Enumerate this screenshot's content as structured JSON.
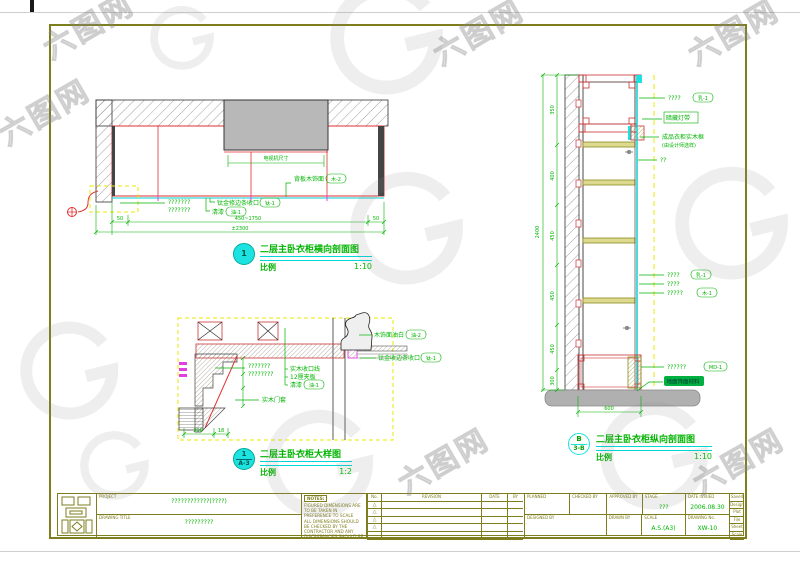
{
  "watermark": {
    "text": "六图网"
  },
  "d1": {
    "bubble": "1",
    "title": "二层主卧衣柜横向剖面图",
    "scale_label": "比例",
    "scale": "1:10",
    "niche_dim": "电视机尺寸",
    "q1": "???????",
    "q2": "???????",
    "lbl_ti": "钛金修边条收口",
    "tag_ti": "钛-1",
    "lbl_qi": "清漆",
    "tag_qi": "油-1",
    "lbl_back": "背板木饰面",
    "tag_back": "木-2",
    "dim_50l": "50",
    "dim_mid": "450~1750",
    "dim_50r": "50",
    "dim_total": "±2300"
  },
  "d2": {
    "bubble_top": "1",
    "bubble_bottom": "A-3",
    "title": "二层主卧衣柜大样图",
    "scale_label": "比例",
    "scale": "1:2",
    "q1": "???????",
    "q2": "????????",
    "lbl_door": "实木门套",
    "lbl_trim": "实木收口线",
    "lbl_ply": "12厘夹板",
    "lbl_qi": "清漆",
    "tag_qi": "油-1",
    "lbl_white": "木饰面油白",
    "tag_white": "油-2",
    "lbl_ti": "钛金收边条收口",
    "tag_ti": "钛-1",
    "dim_a": "206",
    "dim_b": "18"
  },
  "d3": {
    "bubble_top": "B",
    "bubble_bottom": "3-B",
    "title": "二层主卧衣柜纵向剖面图",
    "scale_label": "比例",
    "scale": "1:10",
    "r1": "????",
    "r1tag": "乳-1",
    "r2": "暗藏灯带",
    "r3a": "成品衣柜实木框",
    "r3b": "(由设计师选样)",
    "r4": "??",
    "r5": "????",
    "r5tag": "乳-1",
    "r6": "????",
    "r7": "?????",
    "r7tag": "木-1",
    "r8": "??????",
    "r8tag": "MD-1",
    "r9": "地面饰面材料",
    "dims_left": [
      "350",
      "400",
      "450",
      "450",
      "450",
      "300"
    ],
    "dim_left_total": "2400",
    "dim_bottom": "600"
  },
  "titleblock": {
    "project_label": "PROJECT",
    "project_value": "????????????(????)",
    "drawing_title_label": "DRAWING TITLE",
    "drawing_title_value": "?????????",
    "notes_label": "NOTES:",
    "note1": "FIGURED DIMENSIONS ARE TO BE TAKEN IN PREFERENCE TO SCALE",
    "note2": "ALL DIMENSIONS SHOULD BE CHECKED BY THE CONTRACTOR AND ANY DISCREPANCIES SHOULD BE REFERRED TO THE ARCHITECT BEFORE THE WORK COMMENCED ON SITE",
    "rev_no": "No.",
    "rev_label": "REVISION",
    "rev_date": "DATE",
    "rev_by": "BY",
    "rev_mark": "△",
    "fields": {
      "planned": "PLANNED",
      "checked": "CHECKED BY",
      "approved": "APPROVED BY",
      "stage": "STAGE",
      "stage_value": "???",
      "date": "DATE ISSUED",
      "date_value": "2006.08.30",
      "designed": "DESIGNED BY",
      "drawn": "DRAWN BY",
      "scale": "SCALE",
      "scale_value": "A.S.(A3)",
      "dwgno": "DRAWING No.",
      "dwgno_value": "XW-10"
    },
    "side_rows": [
      "Saved By",
      "Design",
      "Plot Date",
      "File No.",
      "Sheet",
      "Scale"
    ]
  }
}
